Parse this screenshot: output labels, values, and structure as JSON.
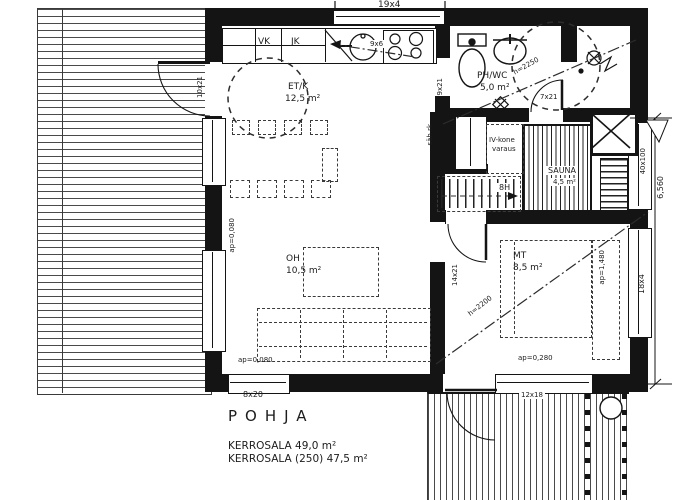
{
  "drawing": {
    "title": "POHJA",
    "area_line1": "KERROSALA 49,0 m²",
    "area_line2": "KERROSALA (250) 47,5 m²"
  },
  "rooms": [
    {
      "label": "ET/K",
      "area": "12,5 m²"
    },
    {
      "label": "PH/WC",
      "area": "5,0 m²"
    },
    {
      "label": "OH",
      "area": "10,5 m²"
    },
    {
      "label": "MT",
      "area": "8,5 m²"
    },
    {
      "label": "SAUNA",
      "area": "4,5 m²"
    }
  ],
  "kitchen": {
    "cabinet_vk": "VK",
    "cabinet_jk": "JK",
    "sink_dim": "9x6"
  },
  "tech": {
    "electrical_panel": "säh rk",
    "hvac_line1": "IV-kone",
    "hvac_line2": "varaus",
    "stair_risers": "8H"
  },
  "dimensions": {
    "top_window": "19x4",
    "right_upper": "40x100",
    "right_total": "6,560",
    "right_window": "18x4",
    "entry_door": "10x21",
    "kitchen_door": "9x21",
    "phwc_door": "7x21",
    "mt_door": "14x21",
    "oh_window": "8x20",
    "deck_door": "12x18",
    "height_phwc": "h=2250",
    "height_mt": "h=2200",
    "sill_oh_left": "ap=0,080",
    "sill_oh_bottom": "ap=0,080",
    "sill_mt_bottom": "ap=0,280",
    "sill_mt_right": "ap=1,480"
  },
  "colors": {
    "line": "#141414",
    "background": "#ffffff",
    "hatch": "#4a4a4a"
  }
}
